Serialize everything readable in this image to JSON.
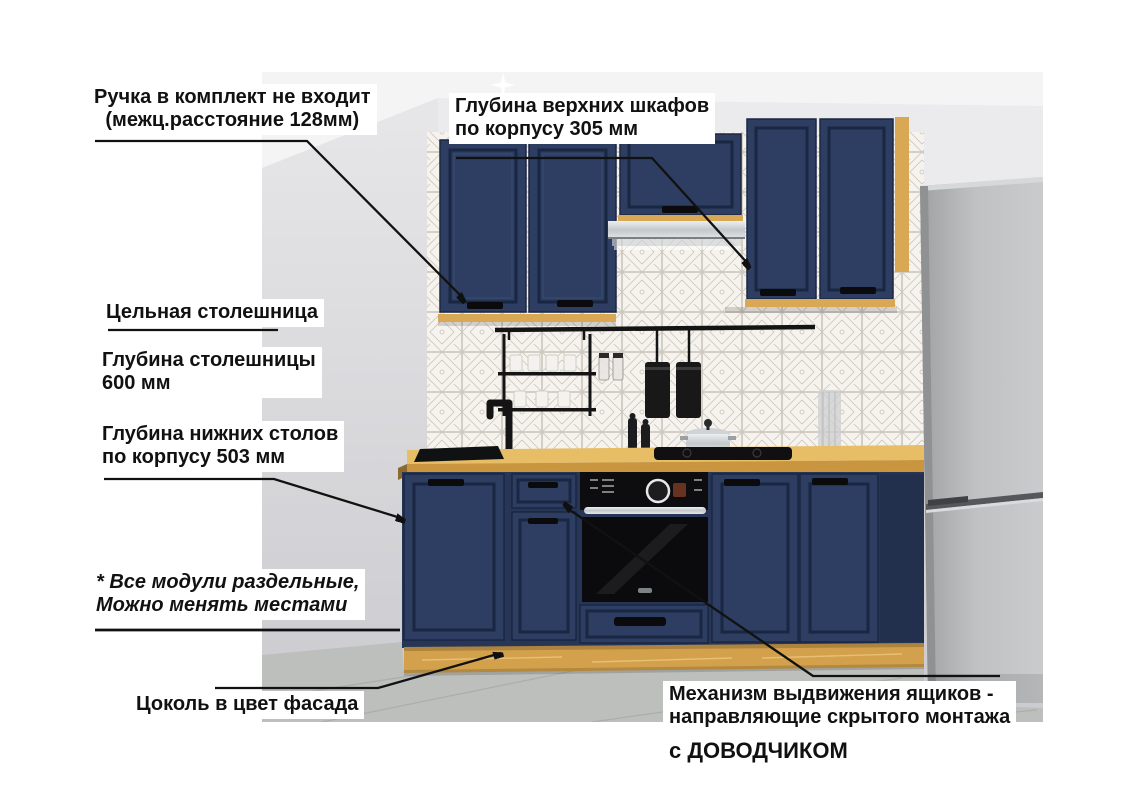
{
  "annotations": {
    "handle_note": {
      "line1": "Ручка в комплект не входит",
      "line2": "(межц.расстояние 128мм)"
    },
    "upper_depth": {
      "line1": "Глубина верхних шкафов",
      "line2": "по корпусу 305 мм"
    },
    "solid_countertop": {
      "line1": "Цельная столешница"
    },
    "countertop_depth": {
      "line1": "Глубина столешницы",
      "line2": "600 мм"
    },
    "base_depth": {
      "line1": "Глубина нижних столов",
      "line2": "по корпусу 503 мм"
    },
    "modules_note": {
      "line1": "* Все модули раздельные,",
      "line2": "Можно менять местами"
    },
    "plinth_note": {
      "line1": "Цоколь в цвет фасада"
    },
    "drawer_mech": {
      "line1": "Механизм выдвижения ящиков -",
      "line2": "направляющие скрытого монтажа",
      "line3": "с ДОВОДЧИКОМ"
    }
  },
  "colors": {
    "cabinet_navy": "#2e3e62",
    "cabinet_navy_dark": "#1a2742",
    "wood_oak": "#d9a855",
    "wood_oak_light": "#ecc87f",
    "countertop_top": "#e7bd66",
    "countertop_front": "#c9953e",
    "tile_bg": "#f6f3ee",
    "tile_line": "#c2bcb1",
    "wall_grey": "#d9d9db",
    "ceiling_white": "#f4f4f5",
    "floor_grey": "#bcbfbc",
    "fridge_grey": "#b4b6b8",
    "appliance_black": "#111214",
    "metal_silver": "#d6d9db",
    "annotation_text": "#111111",
    "annotation_line": "#111111",
    "label_bg": "#ffffff"
  }
}
